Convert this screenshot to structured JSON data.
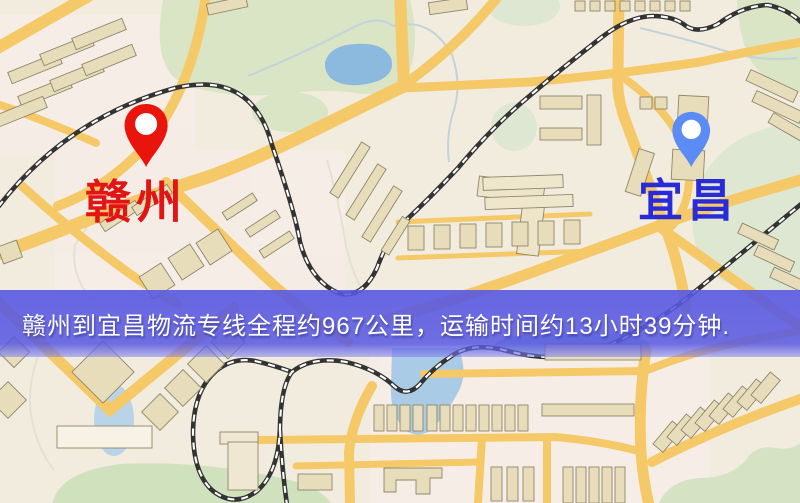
{
  "banner": {
    "text": "赣州到宜昌物流专线全程约967公里，运输时间约13小时39分钟.",
    "bg_color": "#5858e2",
    "text_color": "#ffffff"
  },
  "route": {
    "origin": "赣州",
    "destination": "宜昌",
    "distance_text": "约967公里",
    "duration_text": "约13小时39分钟"
  },
  "markers": {
    "origin": {
      "label": "赣州",
      "pin_color": "#e9150c",
      "label_color": "#e21414"
    },
    "destination": {
      "label": "宜昌",
      "pin_color": "#5b8cf5",
      "label_color": "#2a2ad9"
    }
  },
  "palette": {
    "land": "#f2ecdf",
    "road_yellow": "#f5c968",
    "railway": "#333333",
    "park_green": "#d9e5c5",
    "water_blue": "#8cbade",
    "building_tan": "#e7ddbb"
  }
}
